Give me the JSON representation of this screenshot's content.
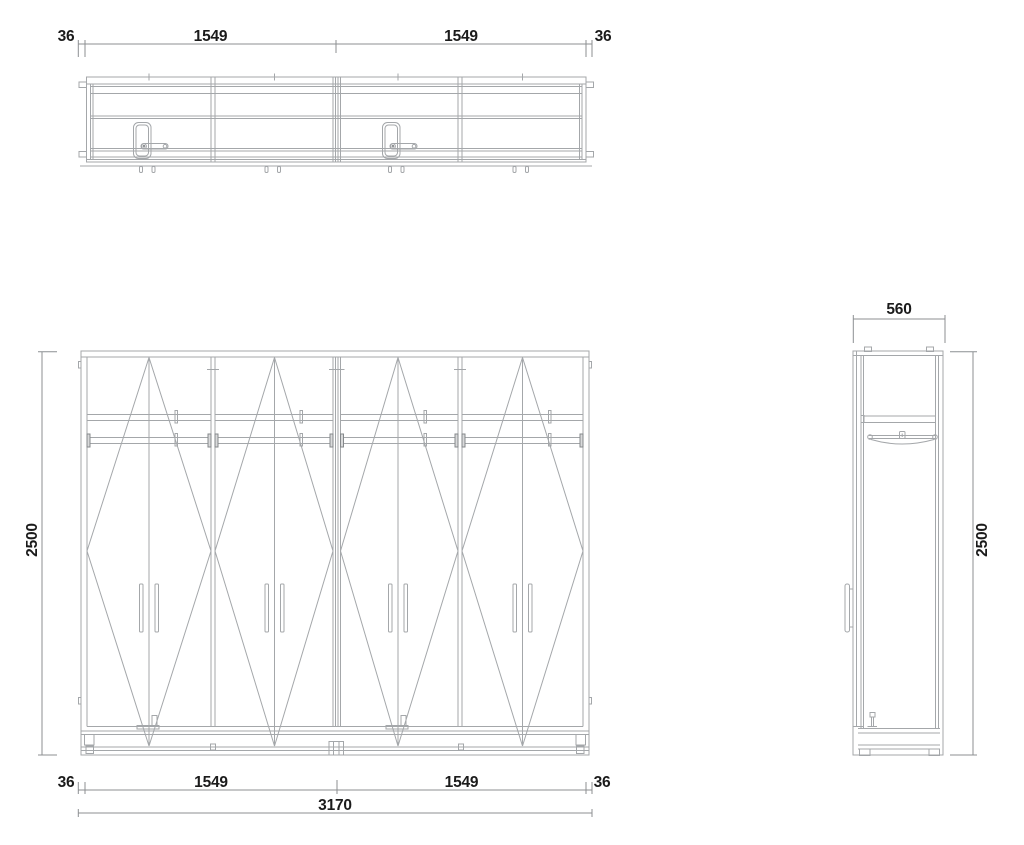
{
  "colors": {
    "background": "#ffffff",
    "drawing_line": "#a4a7aa",
    "dimension_line": "#8c8f92",
    "dimension_text": "#1b1b1b"
  },
  "dimensions": {
    "plan_top": {
      "left_margin": "36",
      "left_bay": "1549",
      "right_bay": "1549",
      "right_margin": "36"
    },
    "front_bottom": {
      "left_margin": "36",
      "left_bay": "1549",
      "right_bay": "1549",
      "right_margin": "36",
      "overall_width": "3170"
    },
    "front_height": "2500",
    "side_height": "2500",
    "side_depth": "560"
  }
}
